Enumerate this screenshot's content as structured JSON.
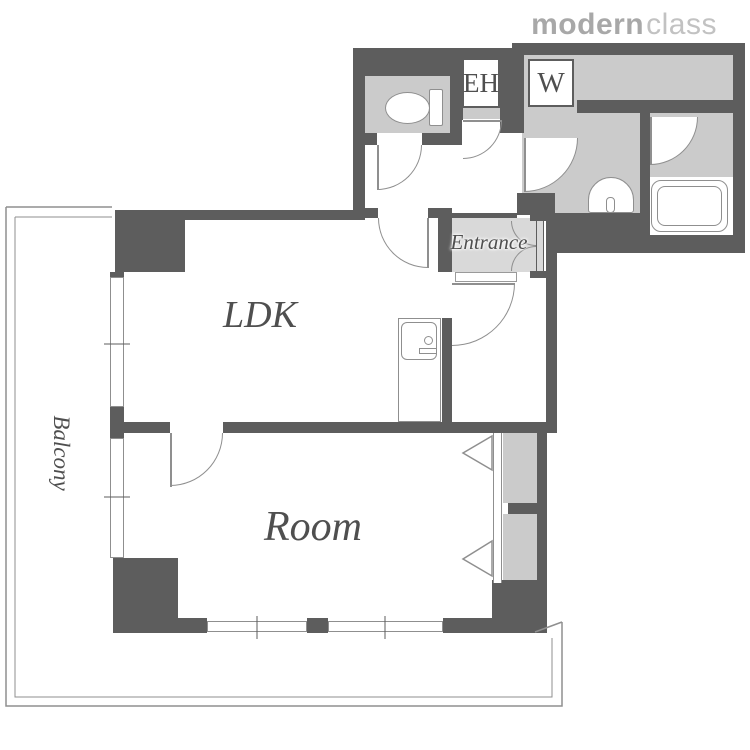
{
  "logo": {
    "bold": "modern",
    "light": "class"
  },
  "labels": {
    "ldk": "LDK",
    "room": "Room",
    "balcony": "Balcony",
    "entrance": "Entrance",
    "elevator_hall": "EH",
    "washing_machine": "W"
  },
  "colors": {
    "wall": "#5d5d5d",
    "room_fill": "#cbcbcb",
    "entrance_fill": "#d9d9d9",
    "line": "#8f8f8f",
    "label_text": "#4f4f4f",
    "logo_bold": "#a8a8a8",
    "logo_light": "#c2c2c2"
  }
}
